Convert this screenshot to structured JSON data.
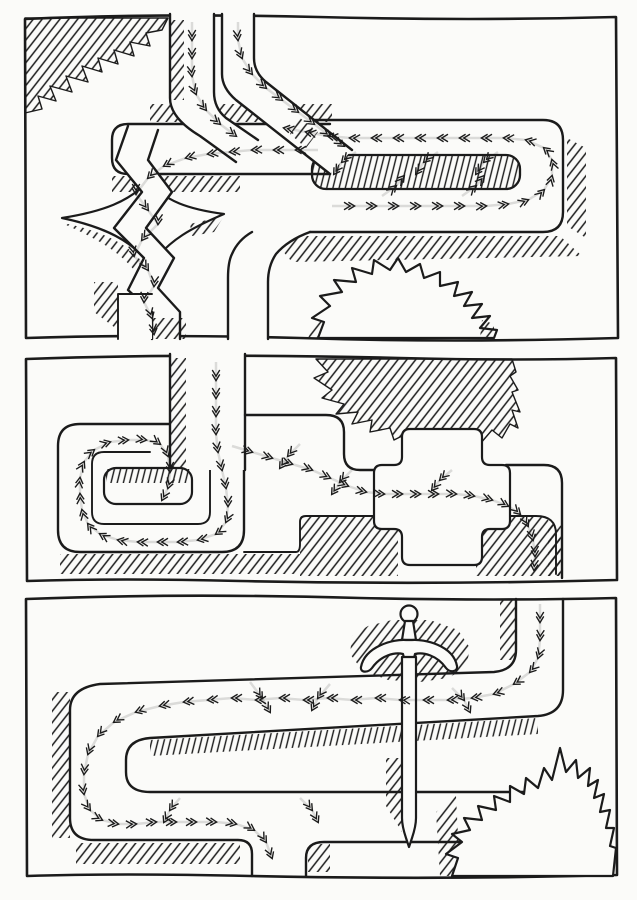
{
  "page": {
    "title": "hand-drawn maze comic page",
    "description": "Black-and-white ink comic page of three borderless-text panels depicting abstract maze corridors marked with feathered chevron arrow trails and cross-hatched shadows",
    "panel_count": 3,
    "ink_color": "#1b1b1b",
    "paper_color": "#fbfbf9"
  },
  "panels": [
    {
      "id": "panel-1",
      "description": "Two corridors descend from the top edge, weave over a horizontal corridor, pass through a four-pointed star shape on the left and loop around a hatched bar island on the right; hatched jagged burst at top-left, outlined jagged burst at bottom-center, exit corridors through the bottom edge"
    },
    {
      "id": "panel-2",
      "description": "A corridor descends from the top edge into a squared spiral coiled around a hatched-top island bar at left, then runs right through a rounded plus-shaped room and turns down at the right; hatched jagged burst hangs from the top edge"
    },
    {
      "id": "panel-3",
      "description": "An S-shaped corridor enters at top-right, flows left, U-turns down the left side and returns right past a long hatched-top island bar before exiting through the bottom edge; a sword with curved crossguard is plunged vertically through the corridors; outlined jagged burst at bottom-right"
    }
  ],
  "legend": {
    "arrow_trail": "feathered chevron arrows marking direction of travel",
    "hatching": "diagonal pen hatching used for shadows and wall faces"
  }
}
